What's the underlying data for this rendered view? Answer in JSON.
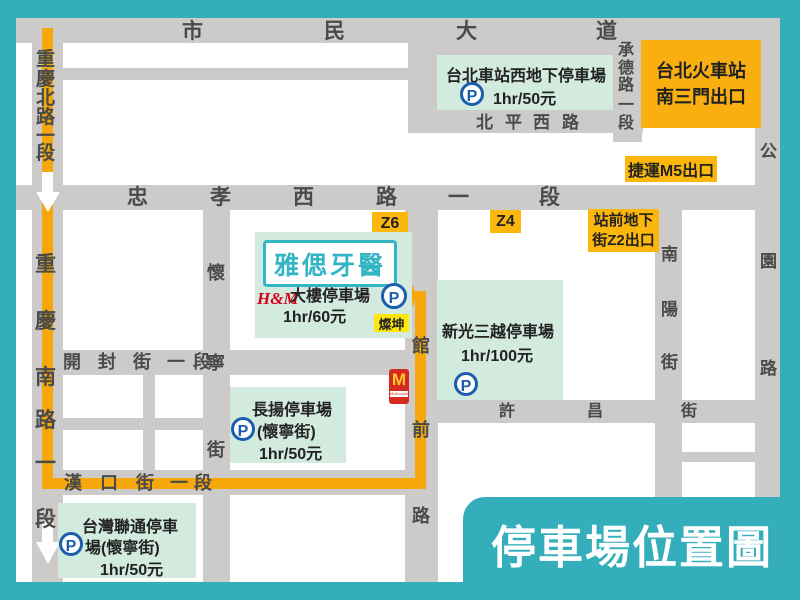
{
  "title": {
    "text": "停車場位置圖"
  },
  "colors": {
    "background_teal": "#35AEBB",
    "street_gray": "#CCCBCA",
    "block_white": "#FFFFFF",
    "parking_box_mint": "#D3EADF",
    "label_amber": "#FBB70B",
    "station_box_orange": "#F9AF10",
    "cankun_yellow": "#FFE70D",
    "route_orange": "#F6A70B",
    "parking_icon_blue": "#1B5EAC",
    "hm_red": "#D6001C",
    "dental_sign_teal": "#33B5C6"
  },
  "streets": {
    "shimin": {
      "name": "市民大道",
      "chars": [
        "市",
        "民",
        "大",
        "道"
      ]
    },
    "cq_north": {
      "name": "重慶北路一段",
      "chars": [
        "重",
        "慶",
        "北",
        "路",
        "一",
        "段"
      ]
    },
    "cq_south": {
      "name": "重慶南路一段",
      "chars": [
        "重",
        "慶",
        "南",
        "路",
        "一",
        "段"
      ]
    },
    "zhongxiao": {
      "name": "忠孝西路一段",
      "chars": [
        "忠",
        "孝",
        "西",
        "路",
        "一",
        "段"
      ]
    },
    "beiping": {
      "name": "北平西路",
      "chars": [
        "北",
        "平",
        "西",
        "路"
      ]
    },
    "chengde": {
      "name": "承德路一段",
      "chars": [
        "承",
        "德",
        "路",
        "一",
        "段"
      ]
    },
    "gongyuan": {
      "name": "公園路",
      "chars": [
        "公",
        "園",
        "路"
      ]
    },
    "nanyang": {
      "name": "南陽街",
      "chars": [
        "南",
        "陽",
        "街"
      ]
    },
    "huaining": {
      "name": "懷寧街",
      "chars": [
        "懷",
        "寧",
        "街"
      ]
    },
    "kaifeng": {
      "name": "開封街一段",
      "chars": [
        "開",
        "封",
        "街",
        "一",
        "段"
      ]
    },
    "hankou": {
      "name": "漢口街一段",
      "chars": [
        "漢",
        "口",
        "街",
        "一",
        "段"
      ]
    },
    "xuchang": {
      "name": "許昌街",
      "chars": [
        "許",
        "昌",
        "街"
      ]
    },
    "guanqian": {
      "name": "館前路",
      "chars": [
        "館",
        "前",
        "路"
      ]
    }
  },
  "parking": {
    "west_underground": {
      "title": "台北車站西地下停車場",
      "rate": "1hr/50元"
    },
    "hm_building": {
      "sign": "雅偲牙醫",
      "brand": "H&M",
      "label": "大樓停車場",
      "rate": "1hr/60元",
      "nearby_store": "燦坤"
    },
    "changyang": {
      "title": "長揚停車場",
      "subtitle": "(懷寧街)",
      "rate": "1hr/50元"
    },
    "shinkong": {
      "title": "新光三越停車場",
      "rate": "1hr/100元"
    },
    "liantong": {
      "title_line1": "台灣聯通停車",
      "title_line2": "場(懷寧街)",
      "rate": "1hr/50元"
    }
  },
  "labels": {
    "station_exit": {
      "line1": "台北火車站",
      "line2": "南三門出口"
    },
    "mrt_m5": "捷運M5出口",
    "z2": {
      "line1": "站前地下",
      "line2": "街Z2出口"
    },
    "z4": "Z4",
    "z6": "Z6",
    "p_letter": "P",
    "mcd_arches": "M",
    "mcd_text": "McDonald's"
  }
}
